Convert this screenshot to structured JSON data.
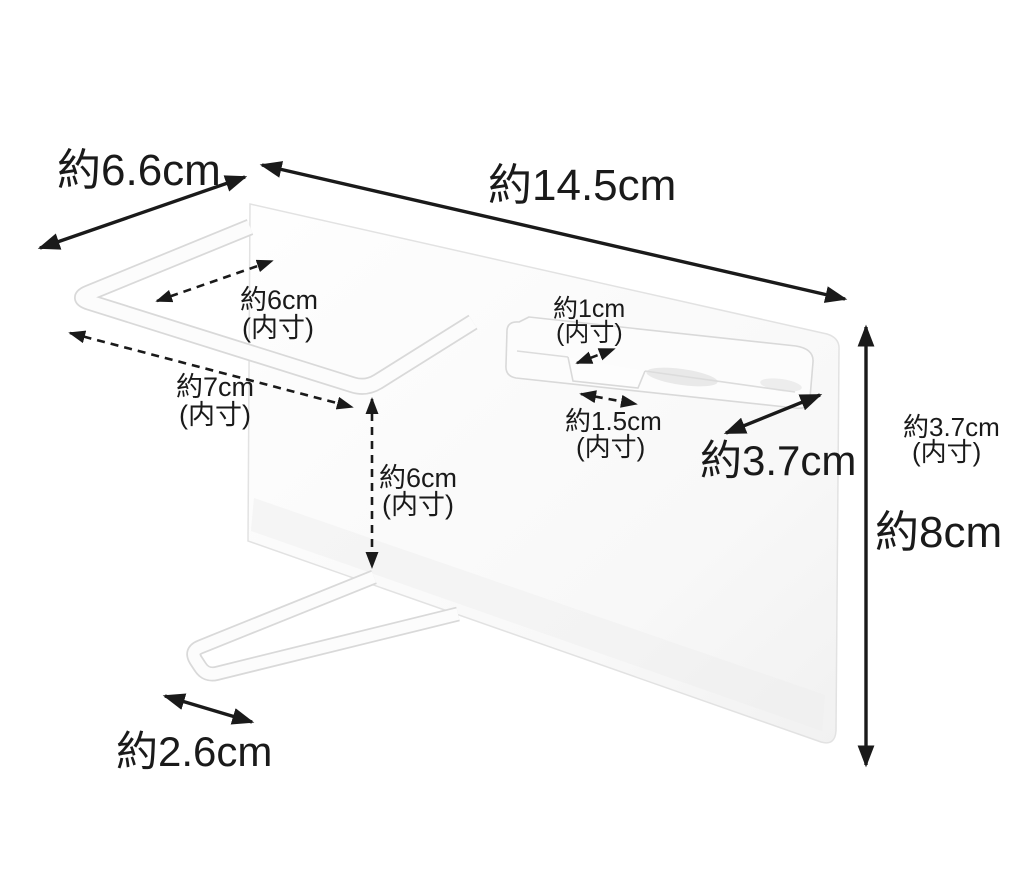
{
  "diagram": {
    "type": "product-dimensions",
    "background": "#ffffff",
    "line_color": "#1a1a1a",
    "product_fill": "#fcfcfc",
    "product_edge": "#d9d9d9",
    "dimensions": {
      "overall_depth": {
        "text": "約6.6cm"
      },
      "overall_width": {
        "text": "約14.5cm"
      },
      "overall_height": {
        "text": "約8cm"
      },
      "towel_bar_inner_width": {
        "text": "約6cm",
        "qualifier": "(内寸)"
      },
      "towel_bar_inner_depth": {
        "text": "約7cm",
        "qualifier": "(内寸)"
      },
      "slot_inner_depth": {
        "text": "約1cm",
        "qualifier": "(内寸)"
      },
      "slot_inner_width": {
        "text": "約1.5cm",
        "qualifier": "(内寸)"
      },
      "holder_width": {
        "text": "約3.7cm"
      },
      "holder_inner_height": {
        "text": "約3.7cm",
        "qualifier": "(内寸)"
      },
      "clearance_height": {
        "text": "約6cm",
        "qualifier": "(内寸)"
      },
      "bottom_bar_inner_width": {
        "text": "約2.6cm"
      }
    }
  }
}
